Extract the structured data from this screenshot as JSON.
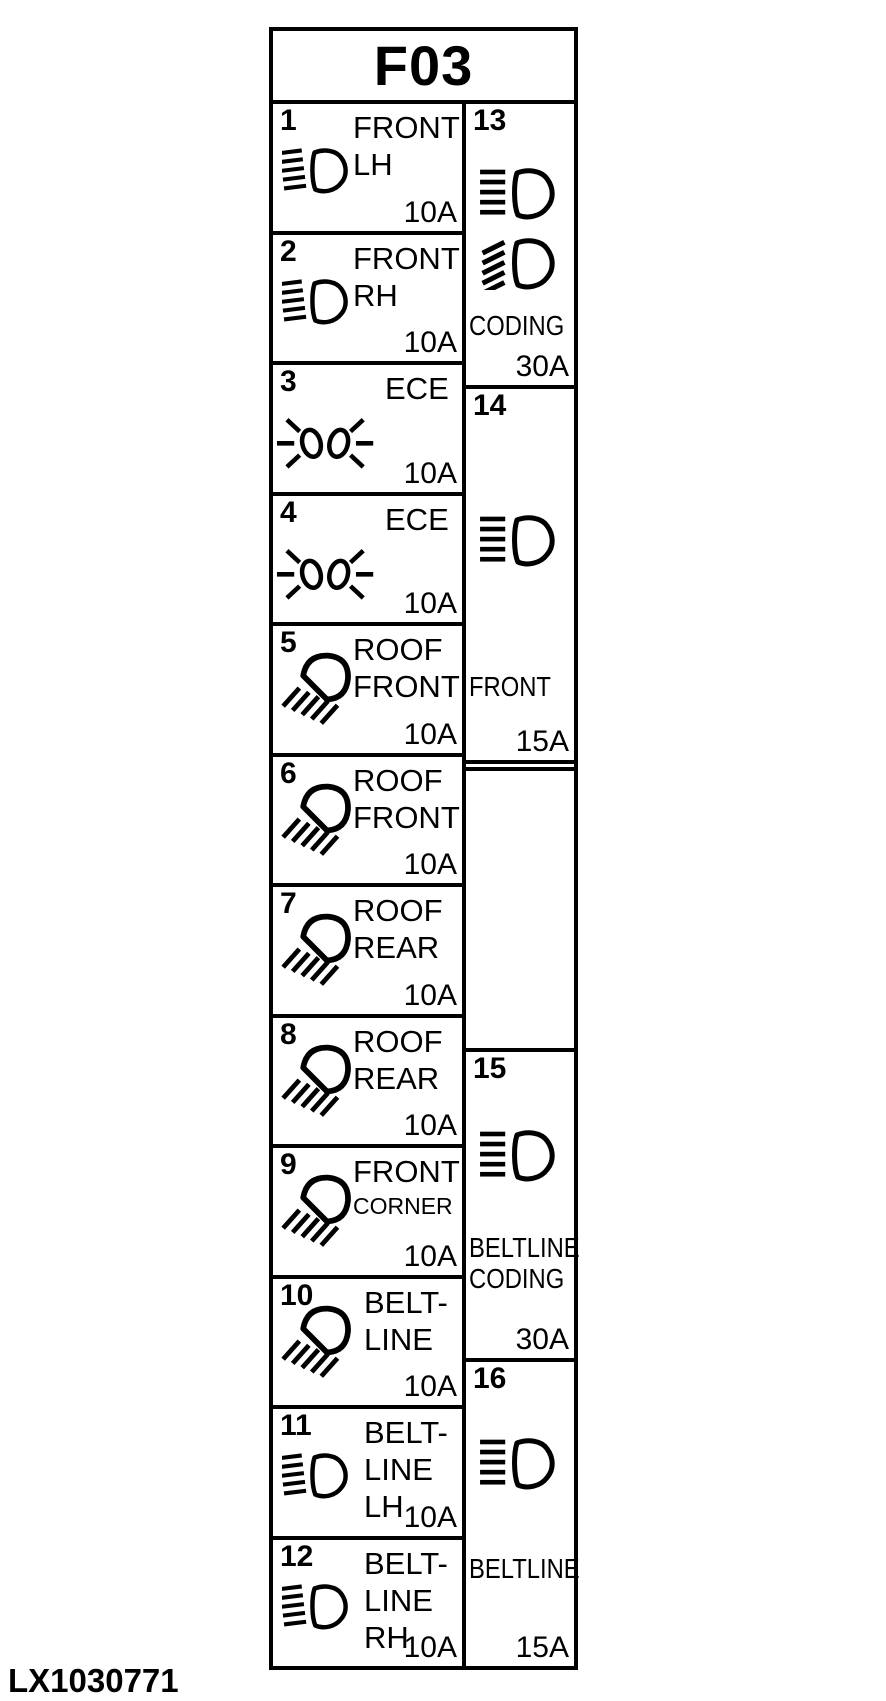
{
  "figure": {
    "title": "F03",
    "code": "LX1030771"
  },
  "colors": {
    "ink": "#000000",
    "paper": "#ffffff"
  },
  "left_fuses": [
    {
      "number": "1",
      "icon": "headlight-icon",
      "lines": [
        "FRONT",
        "LH"
      ],
      "amp": "10A"
    },
    {
      "number": "2",
      "icon": "headlight-icon",
      "lines": [
        "FRONT",
        "RH"
      ],
      "amp": "10A"
    },
    {
      "number": "3",
      "icon": "position-lamps-icon",
      "lines": [
        "ECE"
      ],
      "amp": "10A"
    },
    {
      "number": "4",
      "icon": "position-lamps-icon",
      "lines": [
        "ECE"
      ],
      "amp": "10A"
    },
    {
      "number": "5",
      "icon": "work-lamp-icon",
      "lines": [
        "ROOF",
        "FRONT"
      ],
      "amp": "10A"
    },
    {
      "number": "6",
      "icon": "work-lamp-icon",
      "lines": [
        "ROOF",
        "FRONT"
      ],
      "amp": "10A"
    },
    {
      "number": "7",
      "icon": "work-lamp-icon",
      "lines": [
        "ROOF",
        "REAR"
      ],
      "amp": "10A"
    },
    {
      "number": "8",
      "icon": "work-lamp-icon",
      "lines": [
        "ROOF",
        "REAR"
      ],
      "amp": "10A"
    },
    {
      "number": "9",
      "icon": "work-lamp-icon",
      "lines": [
        "FRONT",
        "CORNER"
      ],
      "amp": "10A"
    },
    {
      "number": "10",
      "icon": "work-lamp-icon",
      "lines": [
        "BELT-",
        "LINE"
      ],
      "amp": "10A"
    },
    {
      "number": "11",
      "icon": "headlight-icon",
      "lines": [
        "BELT-",
        "LINE",
        "LH"
      ],
      "amp": "10A"
    },
    {
      "number": "12",
      "icon": "headlight-icon",
      "lines": [
        "BELT-",
        "LINE",
        "RH"
      ],
      "amp": "10A"
    }
  ],
  "right_fuses": [
    {
      "number": "13",
      "icons": [
        "high-beam-icon",
        "low-beam-icon"
      ],
      "lines": [
        "CODING"
      ],
      "amp": "30A"
    },
    {
      "number": "14",
      "icons": [
        "high-beam-icon"
      ],
      "lines": [
        "FRONT"
      ],
      "amp": "15A"
    },
    {
      "number": "15",
      "icons": [
        "high-beam-icon"
      ],
      "lines": [
        "BELTLINE",
        "CODING"
      ],
      "amp": "30A"
    },
    {
      "number": "16",
      "icons": [
        "high-beam-icon"
      ],
      "lines": [
        "BELTLINE"
      ],
      "amp": "15A"
    }
  ]
}
